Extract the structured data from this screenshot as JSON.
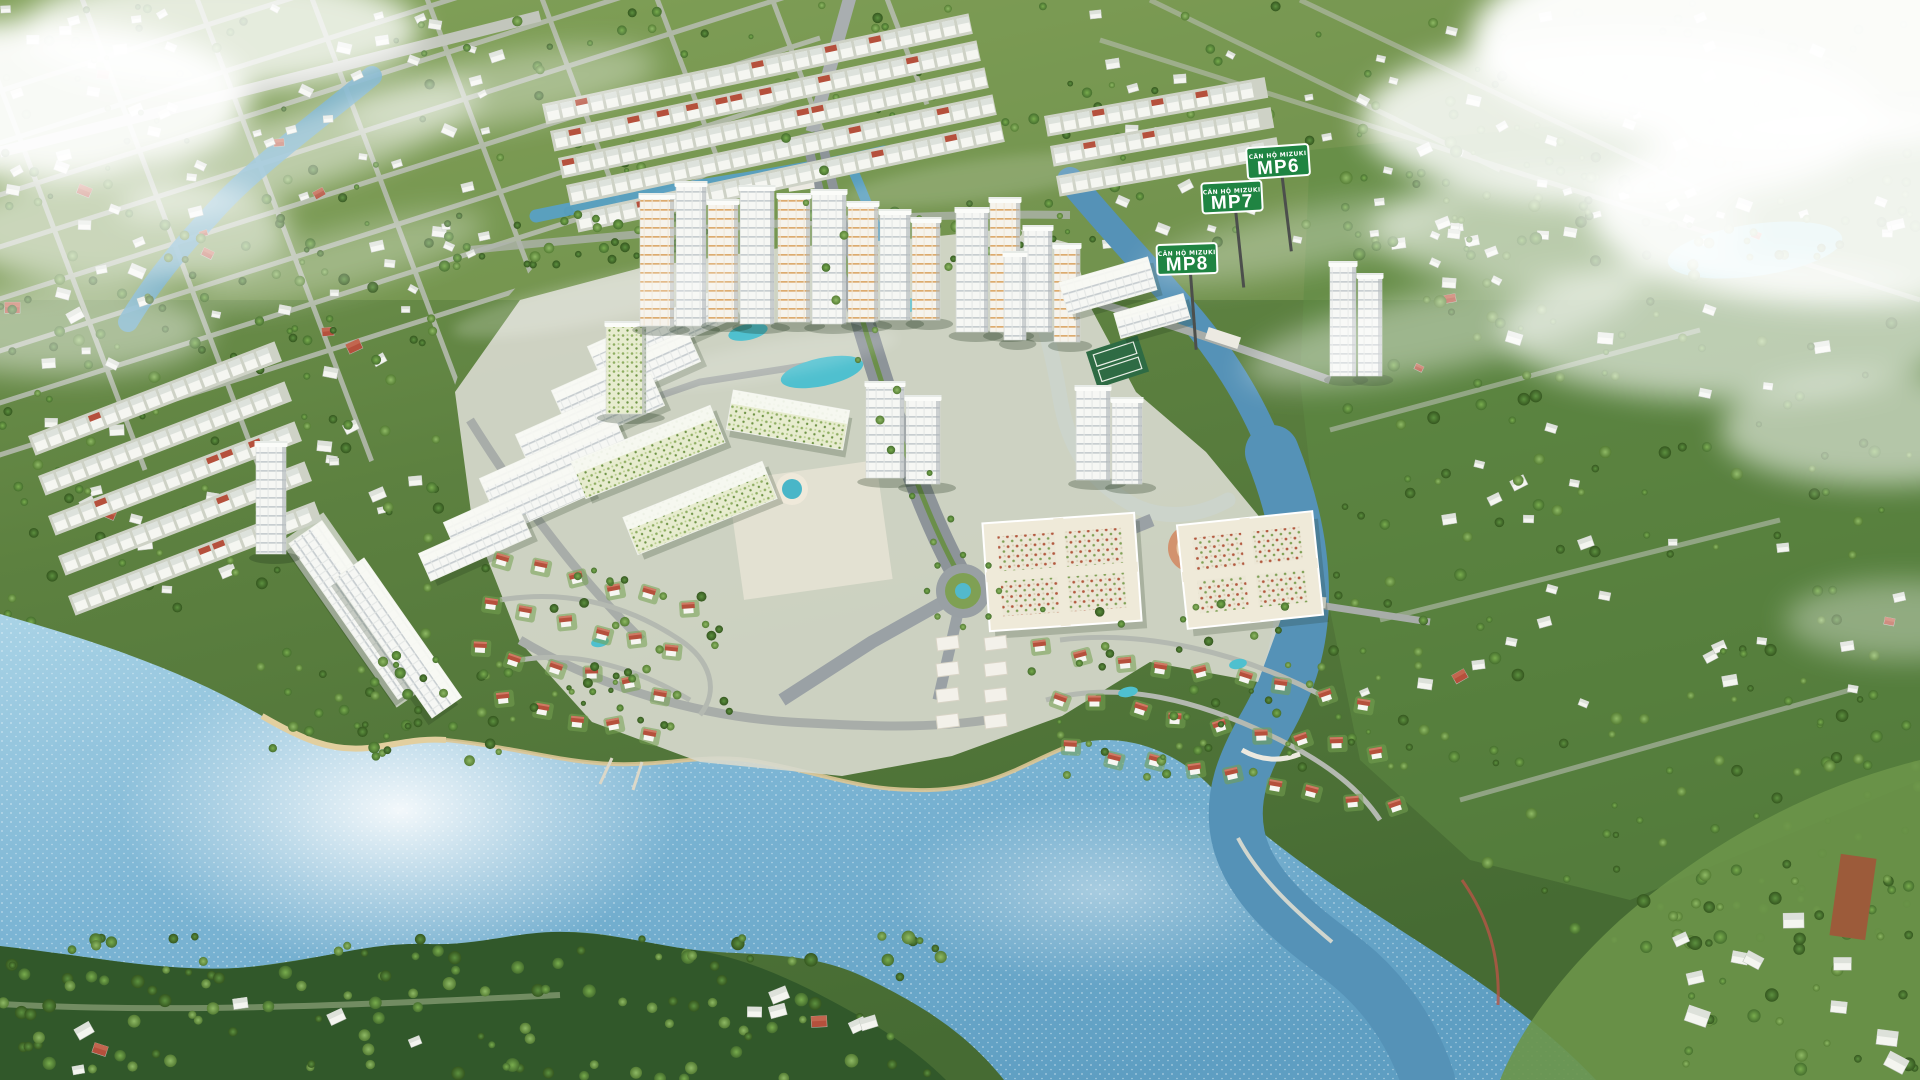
{
  "signs": [
    {
      "id": "mp6",
      "small_label": "CĂN HỘ MIZUKI",
      "label": "MP6"
    },
    {
      "id": "mp7",
      "small_label": "CĂN HỘ MIZUKI",
      "label": "MP7"
    },
    {
      "id": "mp8",
      "small_label": "CĂN HỘ MIZUKI",
      "label": "MP8"
    }
  ],
  "colors": {
    "sign_green": "#1f8442",
    "sign_pole": "#4c4f4c",
    "water_light": "#a9d3e6",
    "water_main": "#79b4d3",
    "water_deep": "#5e9ec2",
    "water_channel": "#5592b7",
    "canal": "#4f99bd",
    "pool_teal": "#4fc0cf",
    "land": "#587c3c",
    "land_light": "#7fa455",
    "land_dark": "#32592b",
    "tree_dark": "#3c6428",
    "tree_mid": "#5d9140",
    "tree_light": "#86b35c",
    "road_light": "#bcc0b4",
    "road_dark": "#939aa0",
    "building_white": "#f5f6f2",
    "building_shade": "#c9ced1",
    "accent_orange": "#e0a568",
    "villa_roof": "#b5503c",
    "sand": "#ddc796",
    "cloud": "#ffffff",
    "fountain": "#49b6c8"
  }
}
